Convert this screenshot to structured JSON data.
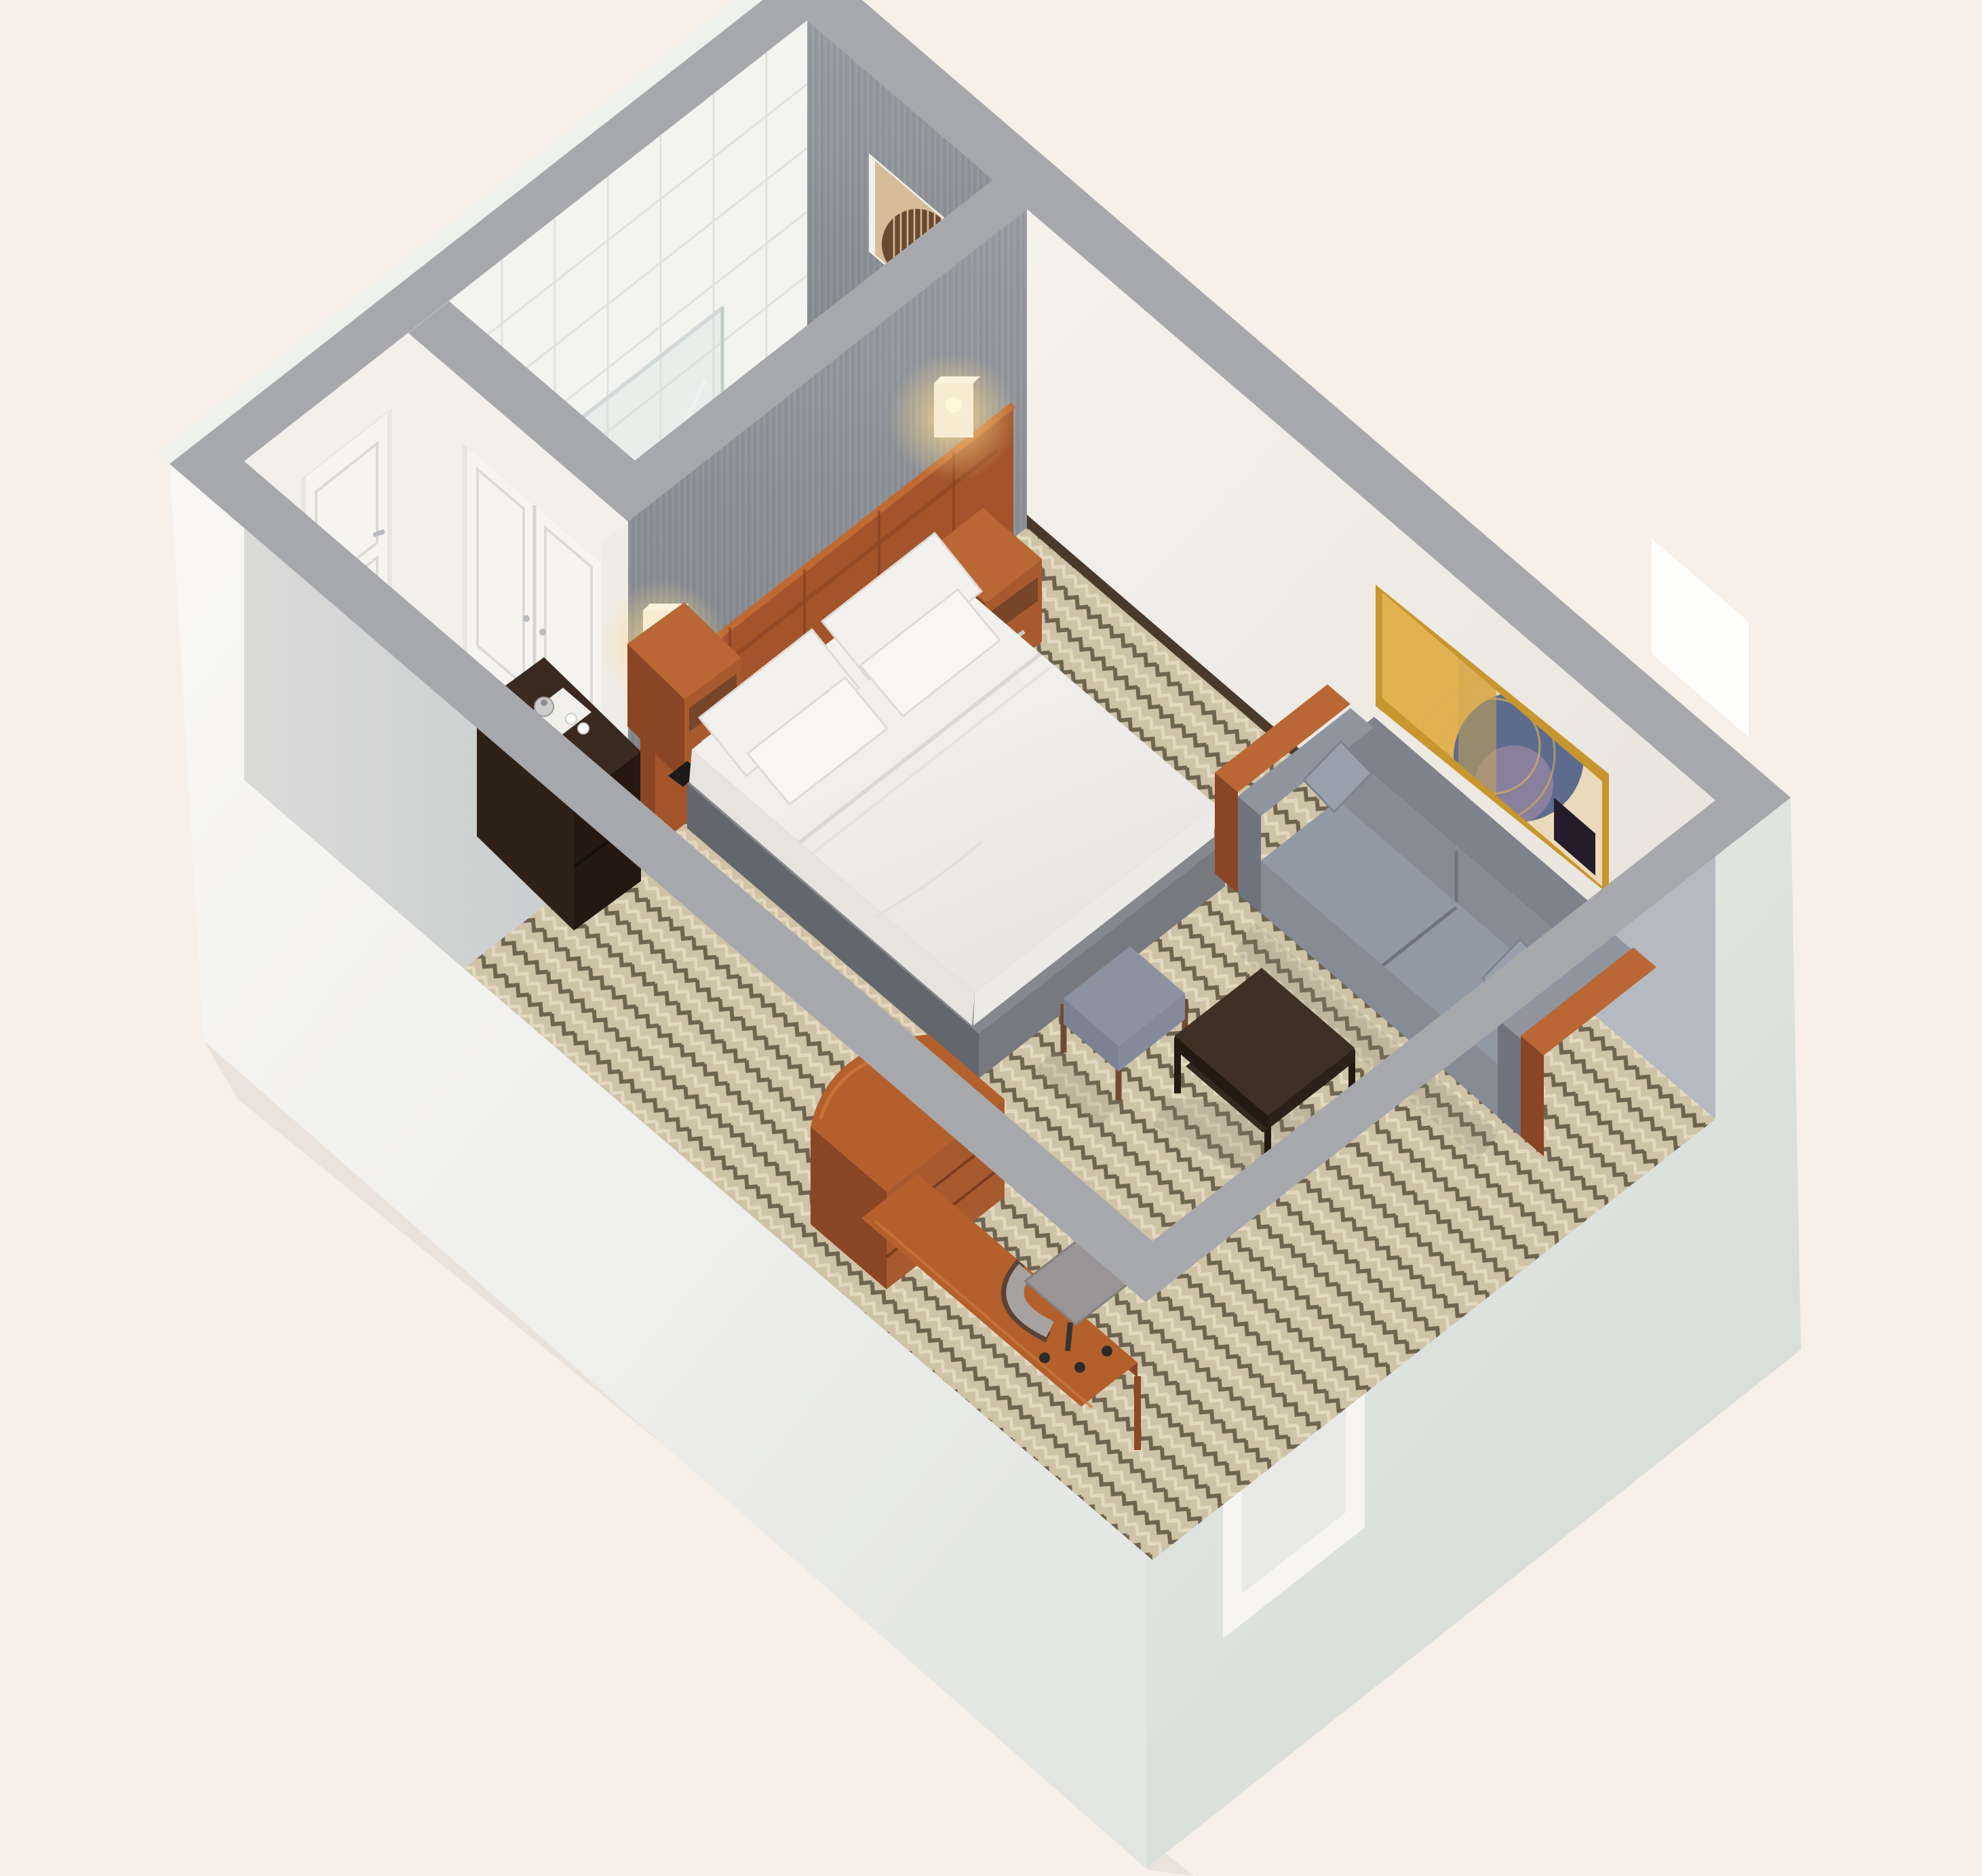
{
  "scene": {
    "type": "isometric-3d-floorplan-rendering",
    "subject": "hotel studio guest room with bathroom, king bed and sofa seating area",
    "view": "bird's-eye cutaway, rotated diamond orientation",
    "rooms": [
      "bathroom",
      "entry-hallway",
      "bedroom-living-area"
    ]
  },
  "objects": {
    "bathroom": [
      "glass-shower",
      "tiled-shower-wall",
      "shower-head",
      "vanity-sink",
      "toilet",
      "towel-bar",
      "framed-wall-art"
    ],
    "hallway": [
      "entry-door",
      "closet-double-door",
      "luggage-bench",
      "wood-threshold"
    ],
    "bedroom": [
      "fabric-accent-wall",
      "wood-headboard",
      "left-wall-lamp",
      "right-wall-lamp",
      "left-nightstand",
      "right-nightstand",
      "coffee-console",
      "king-bed",
      "pillows",
      "foot-dresser-desk",
      "wall-desk-ledge",
      "desk-chair",
      "ottoman",
      "sofa",
      "sofa-side-tables",
      "gold-framed-artwork",
      "coffee-table",
      "window-recess",
      "herringbone-carpet"
    ]
  },
  "palette": {
    "background": "#f6f0e9",
    "wall_top": "#a7a8ac",
    "inner_shadow_wall": "#b6bac0",
    "inner_wall_white": "#f3f0eb",
    "fabric_wall": "#85898e",
    "tile_white": "#f3f3f0",
    "tile_line": "#e2e1dd",
    "bath_floor": "#c6b493",
    "shower_floor": "#d6c8aa",
    "carpet_base": "#cfc3a7",
    "carpet_dark": "#6e6450",
    "carpet_light": "#e3d9c1",
    "wood": "#a85a2f",
    "wood_dark": "#8a4524",
    "wood_top": "#b96734",
    "wood_light": "#c06a33",
    "espresso_top": "#3a2a20",
    "espresso_front": "#241811",
    "espresso_side": "#2e2118",
    "bed_base": "#77797e",
    "bed_base_dark": "#63666b",
    "white_linen": "#f4f2ef",
    "linen_shadow": "#e7e4e0",
    "sofa": "#878b95",
    "sofa_dark": "#6f737e",
    "sofa_light": "#9099a4",
    "ottoman": "#8d92a0",
    "gold_frame": "#c8962e",
    "art_mustard": "#e2b150",
    "art_slate": "#5d6b8c",
    "art_plum": "#241c2b",
    "art_mauve": "#8e83a0",
    "art_cream": "#ead9bb",
    "bath_art_bg": "#d6bd99",
    "bath_art_ink": "#6a4a30",
    "chrome": "#c9cdd1",
    "door_white": "#f6f4f0",
    "glass": "#cfe3de",
    "lamp_glow": "#ffd98c",
    "lamp_shade": "#f7ecd2",
    "toilet": "#f3f3f1",
    "chair_seat": "#999495",
    "chair_frame": "#5a4335",
    "threshold": "#5a4331",
    "baseboard": "#4a3a2c"
  }
}
